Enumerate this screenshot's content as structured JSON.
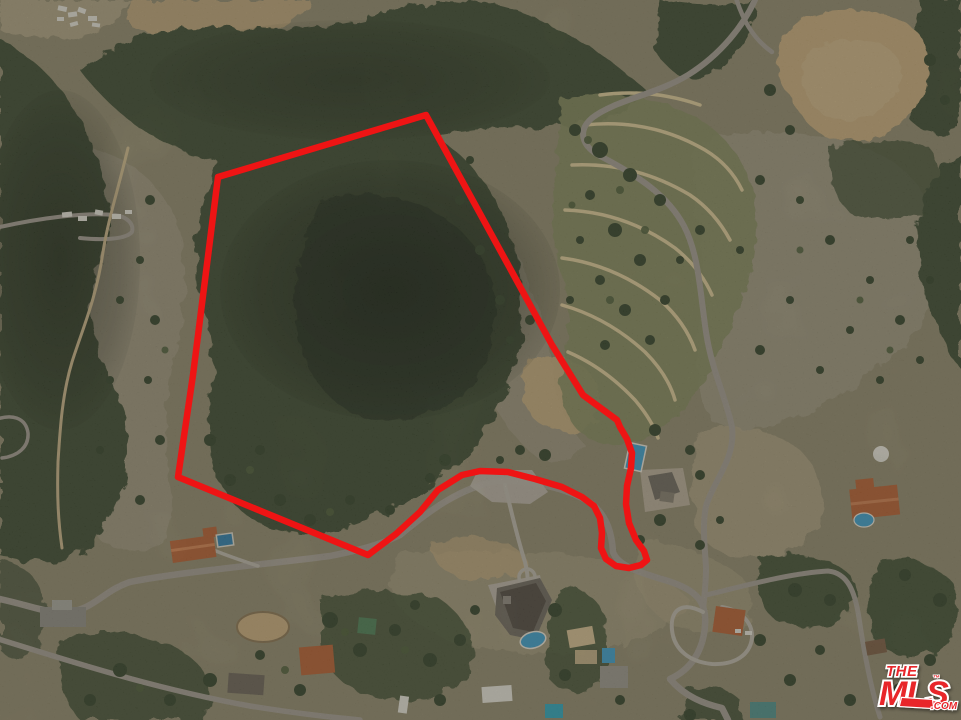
{
  "scene": {
    "description_label": "aerial-parcel-photo",
    "width": 961,
    "height": 720
  },
  "boundary": {
    "color": "#ee1414",
    "stroke_width": "6.5",
    "points": "426,115 218,177 193,375 178,477 368,555 396,534 420,512 438,490 462,475 480,471 508,472 535,479 562,487 582,497 594,506 600,518 602,533 601,548 606,559 616,566 629,568 641,565 647,560 644,551 636,540 629,523 626,504 627,486 631,468 632,453 627,439 620,427 617,420 583,395 552,345"
  },
  "watermark": {
    "brand_the": "THE",
    "brand_mls": "MLS",
    "brand_tm": "™",
    "brand_com": ".COM",
    "color": "#e8262c",
    "outline": "#ffffff"
  },
  "palette": {
    "base": "#8f8769",
    "forest": "#3c4a2d",
    "forest_dark": "#2a3520",
    "tree": "#344227",
    "tree_light": "#4d5c36",
    "scrub_light": "#9c937a",
    "scrub_tan": "#ac9f7d",
    "dirt": "#c7aa78",
    "dirt_light": "#d3bb8d",
    "road": "#a29b8d",
    "road_light": "#bab3a4",
    "trail": "#c6b184",
    "terrace_grass": "#83885a",
    "terrace_path": "#dcc795",
    "pool_blue": "#3e9dc6",
    "pool_deep": "#2e7da6",
    "roof_orange": "#b45f30",
    "roof_gray": "#6e675b",
    "white_struct": "#e4e0d4",
    "shed_green": "#4e7d52",
    "teal_roof": "#4f8f86"
  }
}
